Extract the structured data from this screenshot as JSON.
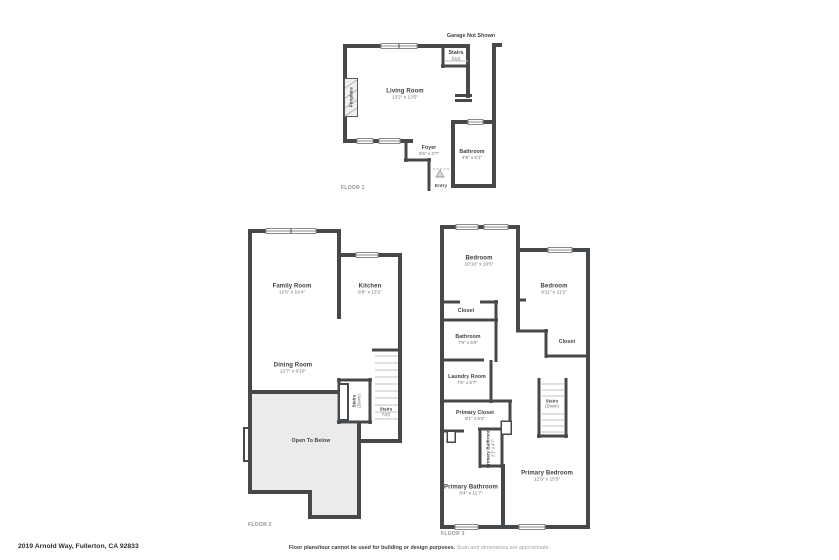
{
  "colors": {
    "wall": "#46494b",
    "open_to_below_fill": "#ebebeb",
    "window_line": "#8a8a8a",
    "stair_tread": "#c2c2c2",
    "background": "#ffffff"
  },
  "footer": {
    "address": "2019 Arnold Way, Fullerton, CA 92833",
    "disclaimer_main": "Floor plans/tour cannot be used for building or design purposes.",
    "disclaimer_sub": "Scan and dimensions are approximate."
  },
  "floor1": {
    "label": "FLOOR 1",
    "garage_note": "Garage Not Shown",
    "entry": "Entry",
    "rooms": {
      "living": {
        "name": "Living Room",
        "dims": "13'2\" x 13'5\""
      },
      "stairs": {
        "name": "Stairs",
        "dims": "(Up)"
      },
      "fireplace": {
        "name": "Fireplace"
      },
      "foyer": {
        "name": "Foyer",
        "dims": "6'6\" x 3'7\""
      },
      "bathroom": {
        "name": "Bathroom",
        "dims": "4'8\" x 5'1\""
      }
    }
  },
  "floor2": {
    "label": "FLOOR 2",
    "rooms": {
      "family": {
        "name": "Family Room",
        "dims": "12'5\" x 16'4\""
      },
      "kitchen": {
        "name": "Kitchen",
        "dims": "8'6\" x 13'2\""
      },
      "dining": {
        "name": "Dining Room",
        "dims": "12'7\" x 9'10\""
      },
      "stairs_down": {
        "name": "Stairs",
        "dims": "(Down)"
      },
      "stairs_up": {
        "name": "Stairs",
        "dims": "(Up)"
      },
      "open_to_below": {
        "name": "Open To Below"
      }
    }
  },
  "floor3": {
    "label": "FLOOR 3",
    "rooms": {
      "bedroom_left": {
        "name": "Bedroom",
        "dims": "10'10\" x 10'5\""
      },
      "bedroom_right": {
        "name": "Bedroom",
        "dims": "9'11\" x 11'2\""
      },
      "closet_left": {
        "name": "Closet"
      },
      "closet_right": {
        "name": "Closet"
      },
      "bathroom": {
        "name": "Bathroom",
        "dims": "7'9\" x 5'6\""
      },
      "laundry": {
        "name": "Laundry Room",
        "dims": "7'8\" x 5'7\""
      },
      "primary_closet": {
        "name": "Primary Closet",
        "dims": "9'1\" x 5'2\""
      },
      "stairs": {
        "name": "Stairs",
        "dims": "(Down)"
      },
      "primary_bathroom_small": {
        "name": "Primary Bathroom",
        "dims": "2'1\" x 4'7\""
      },
      "primary_bathroom": {
        "name": "Primary Bathroom",
        "dims": "8'4\" x 11'7\""
      },
      "primary_bedroom": {
        "name": "Primary Bedroom",
        "dims": "12'5\" x 15'5\""
      }
    }
  }
}
